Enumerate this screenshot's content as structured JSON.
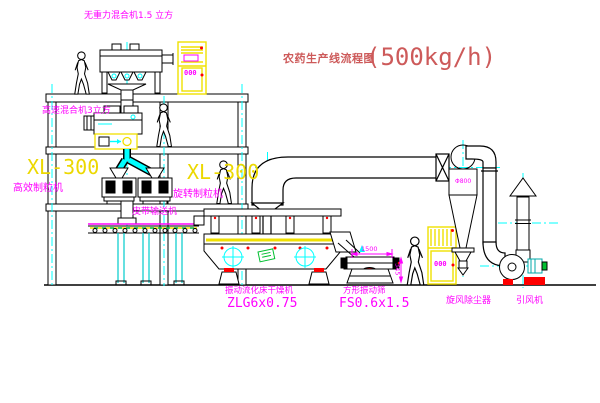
{
  "title": {
    "cn": "农药生产线流程图",
    "capacity": "(500kg/h)"
  },
  "labels": {
    "gravity_mixer": "无重力混合机1.5 立方",
    "high_speed_mixer": "高速混合机3立方",
    "granulator_left_model": "XL-300",
    "granulator_left_name": "高效制粒机",
    "granulator_center_model": "XL-300",
    "granulator_center_name": "旋转制粒机",
    "belt_conveyor": "皮带输送机",
    "dryer_name": "振动流化床干燥机",
    "dryer_model": "ZLG6x0.75",
    "sieve_name": "方形振动筛",
    "sieve_model": "FS0.6x1.5",
    "cyclone_name": "旋风除尘器",
    "fan_name": "引风机",
    "cyclone_diameter": "Φ800",
    "dim_sieve_length": "1500",
    "dim_sieve_height": "345",
    "cabinet1_display": "000",
    "cabinet2_display": "000"
  },
  "colors": {
    "line": "#000000",
    "centerline_cyan": "#00ffff",
    "label_magenta": "#ff00ff",
    "highlight_yellow": "#f0e000",
    "title_red": "#cd5a5a",
    "accent_red": "#ff0000",
    "tag_green": "#00c030",
    "background": "#ffffff"
  }
}
